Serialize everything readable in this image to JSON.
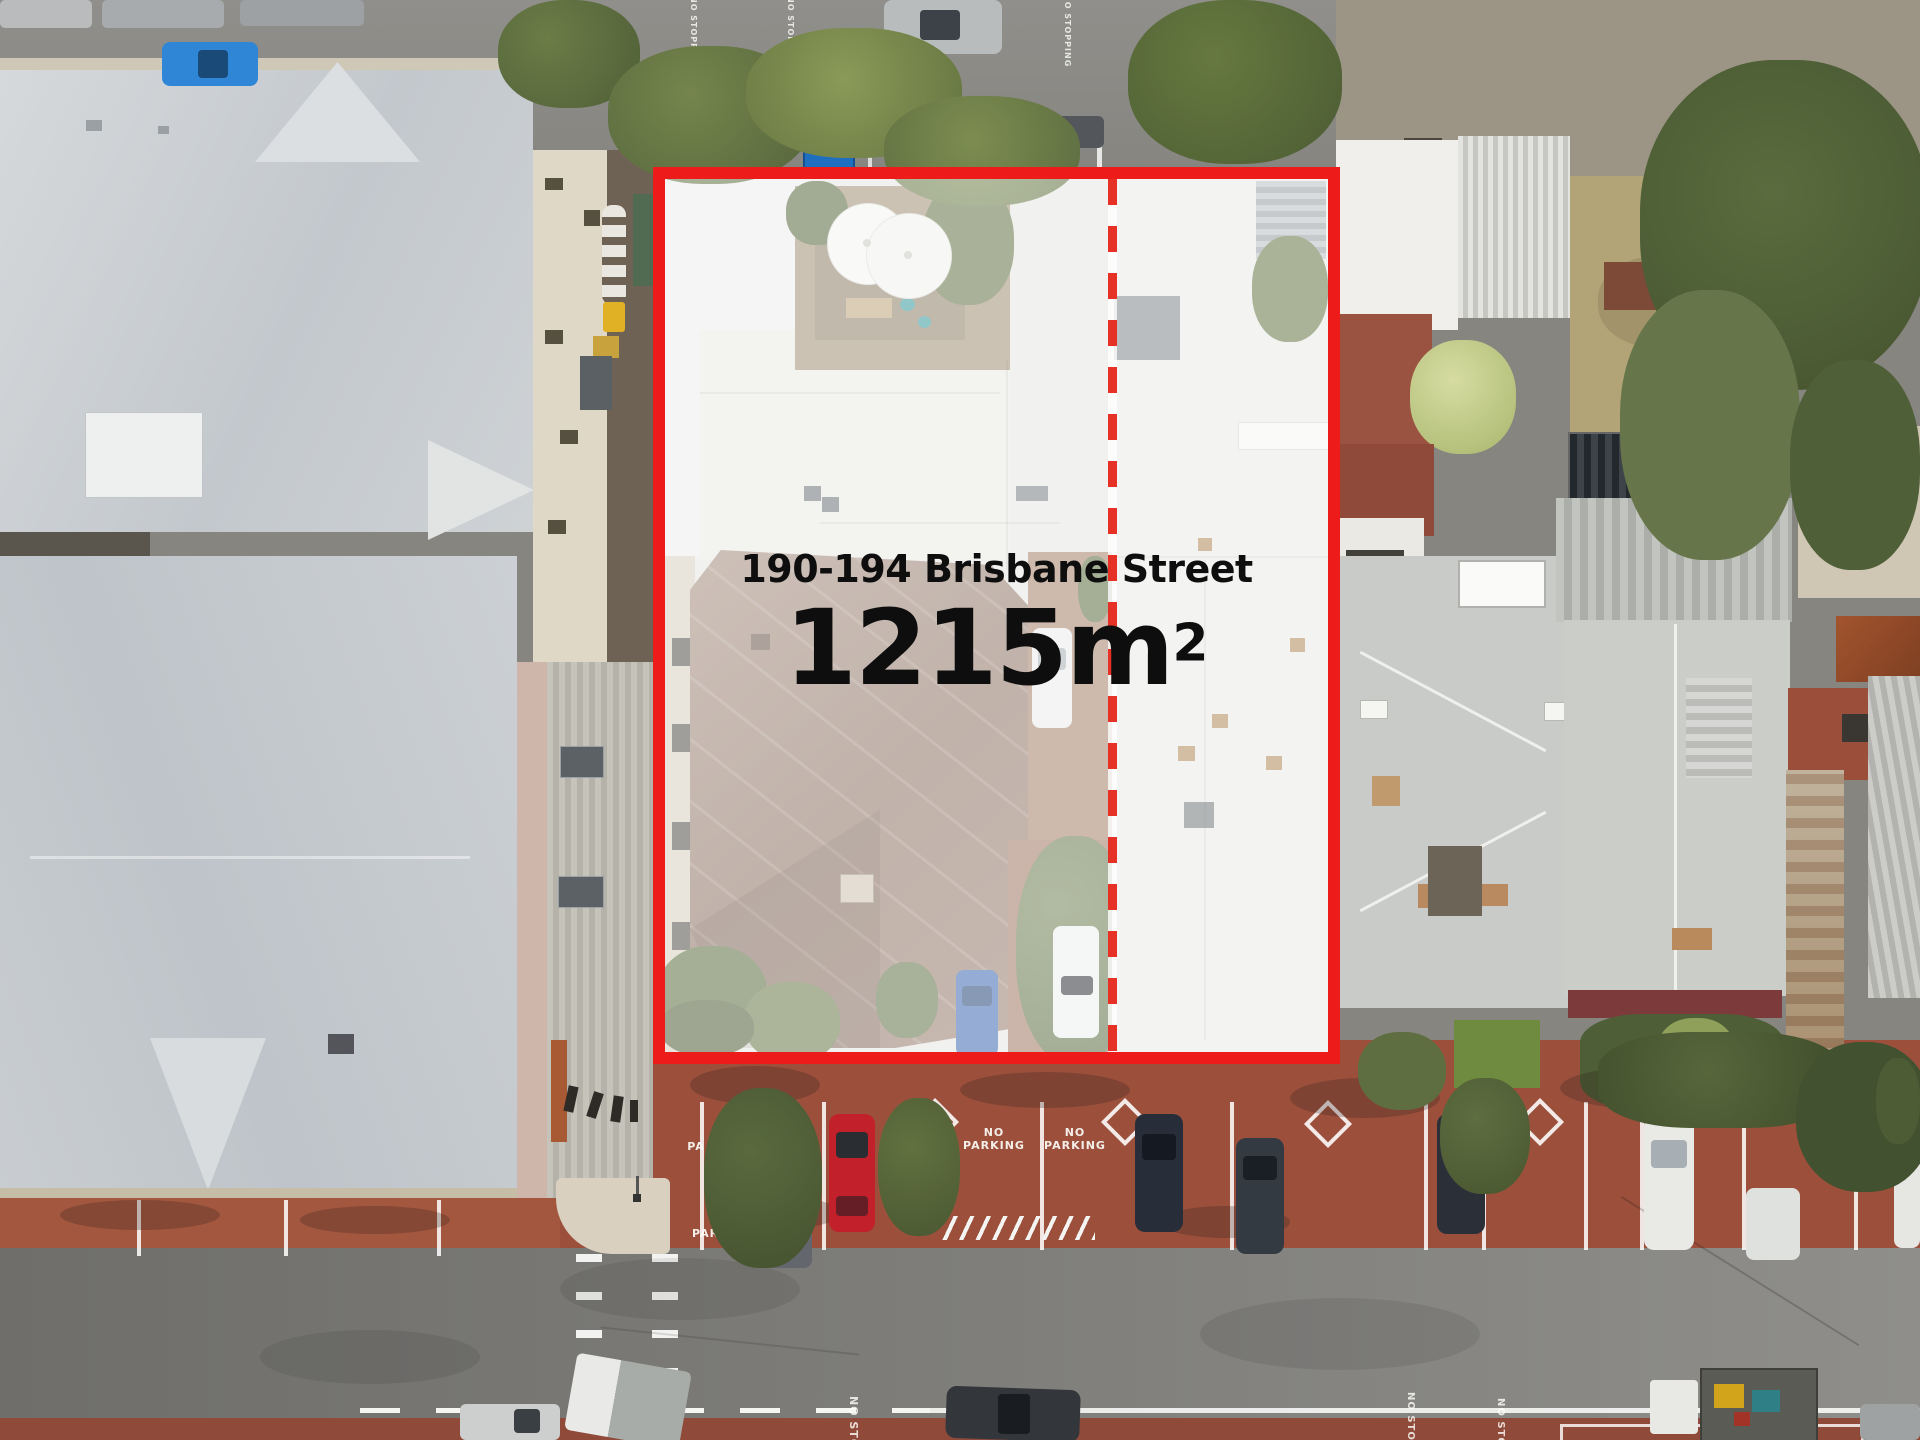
{
  "overlay": {
    "address": "190-194 Brisbane Street",
    "area_value": "1215",
    "area_unit": "m",
    "area_exponent": "2",
    "area_display": "1215m²",
    "boundary_color": "#ee1b1b",
    "boundary_style": "solid",
    "divider_color": "#e63226",
    "divider_style": "dashed",
    "veil_color": "rgba(255,255,255,0.44)",
    "text_color": "#0e0e0e"
  },
  "road_markings": {
    "no_parking_a": {
      "line1": "NO",
      "line2": "PARKING"
    },
    "no_parking_b": {
      "line1": "NO",
      "line2": "PARKING"
    },
    "no_parking_c": {
      "line1": "NO",
      "line2": "PARKING"
    },
    "parking_fragment": "PA",
    "no_stopping_kerb": "NO STOPPING",
    "no_stopping_east_a": "NO STOPPING",
    "no_stopping_east_b": "NO STOPPING",
    "no_stopping_lane_a": "NO STOPPING",
    "no_stopping_lane_b": "NO STOPPING",
    "no_stopping_lane_c": "NO STOPPING",
    "no_stopping_lane_d": "NO STOPPING"
  },
  "scene": {
    "palette": {
      "asphalt_lane": "#8b8a86",
      "road": "#7d7c78",
      "brick_paving": "#9c503c",
      "roof_metal_light": "#cdd1d4",
      "roof_white": "#e7e7e3",
      "roof_terracotta_brown": "#97806f",
      "foliage_dark": "#4e5c36",
      "foliage_light": "#77884b",
      "rust_roof": "#a2542e",
      "solar_panel": "#2b3136",
      "umbrella_white": "#f4f4f1",
      "cream_wall": "#e0d8c6",
      "maroon_band": "#7c3a3a"
    }
  }
}
